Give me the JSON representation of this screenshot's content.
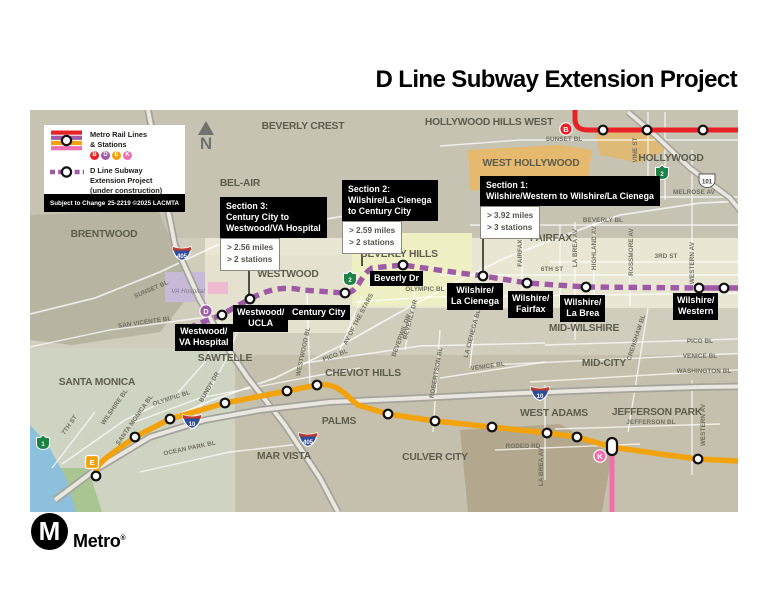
{
  "title": "D Line Subway Extension Project",
  "legend": {
    "rail_label_1": "Metro Rail Lines",
    "rail_label_2": "& Stations",
    "badges": [
      "B",
      "D",
      "E",
      "K"
    ],
    "ext_label_1": "D Line Subway",
    "ext_label_2": "Extension Project",
    "ext_label_3": "(under construction)",
    "subject": "Subject to Change",
    "code": "25-2219 ©2025 LACMTA",
    "north": "N"
  },
  "sections": [
    {
      "label": "Section 1:",
      "route": [
        "Wilshire/Western to Wilshire/La Cienega"
      ],
      "miles": "> 3.92 miles",
      "stations": "> 3 stations"
    },
    {
      "label": "Section 2:",
      "route": [
        "Wilshire/La Cienega",
        "to Century City"
      ],
      "miles": "> 2.59 miles",
      "stations": "> 2 stations"
    },
    {
      "label": "Section 3:",
      "route": [
        "Century City to",
        "Westwood/VA Hospital"
      ],
      "miles": "> 2.56 miles",
      "stations": "> 2 stations"
    }
  ],
  "stations": [
    {
      "l1": "Westwood/",
      "l2": "VA Hospital"
    },
    {
      "l1": "Westwood/",
      "l2": "UCLA"
    },
    {
      "l1": "Century City",
      "l2": ""
    },
    {
      "l1": "Beverly Dr",
      "l2": ""
    },
    {
      "l1": "Wilshire/",
      "l2": "La Cienega"
    },
    {
      "l1": "Wilshire/",
      "l2": "Fairfax"
    },
    {
      "l1": "Wilshire/",
      "l2": "La Brea"
    },
    {
      "l1": "Wilshire/",
      "l2": "Western"
    }
  ],
  "neighborhoods": [
    "BEVERLY CREST",
    "HOLLYWOOD HILLS WEST",
    "WEST HOLLYWOOD",
    "HOLLYWOOD",
    "BEL-AIR",
    "BRENTWOOD",
    "WESTWOOD",
    "BEVERLY HILLS",
    "FAIRFAX",
    "MID-WILSHIRE",
    "MID-CITY",
    "SANTA MONICA",
    "SAWTELLE",
    "CHEVIOT HILLS",
    "PALMS",
    "MAR VISTA",
    "CULVER CITY",
    "WEST ADAMS",
    "JEFFERSON PARK"
  ],
  "streets": {
    "sunset_top": "SUNSET BL",
    "vine": "VINE ST",
    "melrose": "MELROSE AV",
    "beverly_bl": "BEVERLY BL",
    "third_st": "3RD ST",
    "sixth_st": "6TH ST",
    "olympic_bh": "OLYMPIC BL",
    "pico_right": "PICO BL",
    "venice_right": "VENICE BL",
    "washington_right": "WASHINGTON BL",
    "sunset_brentwood": "SUNSET BL",
    "san_vicente": "SAN VICENTE BL",
    "va_hospital": "VA Hospital",
    "wilshire_sm": "WILSHIRE BL",
    "santa_monica_bl": "SANTA MONICA BL",
    "seventh_st": "7TH ST",
    "olympic_sm": "OLYMPIC BL",
    "bundy": "BUNDY DR",
    "ocean_park": "OCEAN PARK BL",
    "westwood_bl": "WESTWOOD BL",
    "pico_westwood": "PICO BL",
    "av_of_the_stars": "AV OF THE STARS",
    "beverly_dr": "BEVERLY DR",
    "beverwil": "BEVERWIL DR",
    "robertson": "ROBERTSON BL",
    "la_cienega_bl": "LA CIENEGA BL",
    "fairfax_av": "FAIRFAX AV",
    "la_brea_av": "LA BREA AV",
    "highland": "HIGHLAND AV",
    "rossmore": "ROSSMORE AV",
    "western_av": "WESTERN AV",
    "crenshaw": "CRENSHAW BL",
    "venice_mid": "VENICE BL",
    "rodeo": "RODEO RD",
    "jefferson": "JEFFERSON BL",
    "la_brea_south": "LA BREA AV",
    "western_south": "WESTERN AV"
  },
  "route_shields": {
    "i405": "405",
    "i10": "10",
    "us101": "101",
    "sr1": "1",
    "sr2": "2"
  },
  "line_badges": {
    "b": "B",
    "d": "D",
    "e": "E",
    "k": "K"
  },
  "logo": {
    "letter": "M",
    "wordmark": "Metro",
    "reg": "®"
  },
  "colors": {
    "b_line_red": "#e82127",
    "d_line_purple": "#9e5aa7",
    "e_line_gold": "#f2a30c",
    "k_line_pink": "#f06eb0",
    "map_base": "#d0cdbd",
    "label_black": "#000000"
  }
}
